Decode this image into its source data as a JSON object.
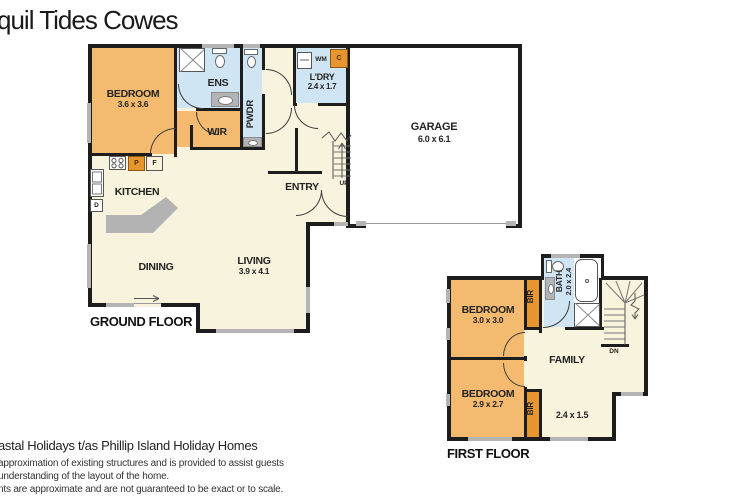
{
  "title": "quil Tides Cowes",
  "ground_floor": {
    "label": "GROUND FLOOR",
    "bedroom": {
      "name": "BEDROOM",
      "dim": "3.6 x 3.6"
    },
    "ens": "ENS",
    "wir": "WIR",
    "pwdr": "PWDR",
    "ldry": {
      "name": "L'DRY",
      "dim": "2.4 x 1.7"
    },
    "garage": {
      "name": "GARAGE",
      "dim": "6.0 x 6.1"
    },
    "kitchen": "KITCHEN",
    "entry": "ENTRY",
    "dining": "DINING",
    "living": {
      "name": "LIVING",
      "dim": "3.9 x 4.1"
    },
    "up": "UP",
    "appliances": {
      "wm": "WM",
      "c": "C",
      "p": "P",
      "f": "F",
      "d": "D"
    }
  },
  "first_floor": {
    "label": "FIRST FLOOR",
    "bedroom_a": {
      "name": "BEDROOM",
      "dim": "3.0 x 3.0"
    },
    "bedroom_b": {
      "name": "BEDROOM",
      "dim": "2.9 x 2.7"
    },
    "bath": {
      "name": "BATH",
      "dim": "2.0 x 2.4"
    },
    "family": "FAMILY",
    "landing_dim": "2.4 x 1.5",
    "bir_a": "BIR",
    "bir_b": "BIR",
    "dn": "DN"
  },
  "footer": {
    "line1": "astal Holidays t/as Phillip Island Holiday Homes",
    "line2": "approximation of existing structures and is provided to assist guests",
    "line3": "understanding of the layout of the home.",
    "line4": "nts are approximate and are not guaranteed to be exact or to scale."
  },
  "colors": {
    "floor_cream": "#f8f3dc",
    "room_orange": "#f4ba70",
    "accent_orange": "#e6952f",
    "wet_area_blue": "#cfe5f3",
    "wall_black": "#1d1d1d",
    "window_gray": "#b4b4b4",
    "garage_white": "#ffffff",
    "text_dark": "#242424"
  }
}
